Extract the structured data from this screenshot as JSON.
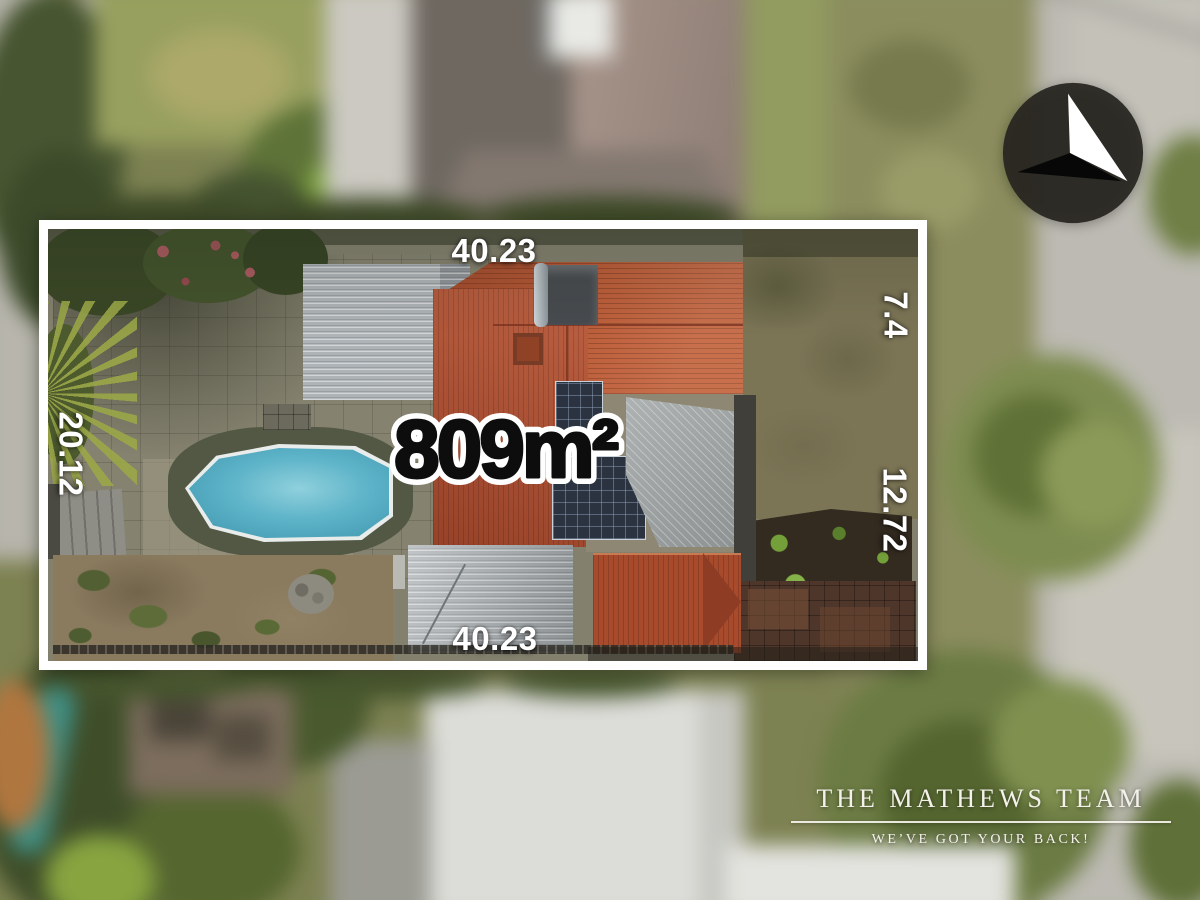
{
  "overlay": {
    "area_label": "809m²",
    "dimensions": {
      "top": "40.23",
      "bottom": "40.23",
      "left": "20.12",
      "right_upper": "7.4",
      "right_lower": "12.72"
    }
  },
  "branding": {
    "team_name": "THE MATHEWS TEAM",
    "tagline": "WE’VE GOT YOUR BACK!"
  },
  "icons": {
    "compass": "north-arrow-icon"
  },
  "colors": {
    "boundary": "#ffffff",
    "dimension_text": "#ffffff",
    "area_text": "#0d0d0d",
    "area_outline": "#ffffff",
    "roof_terracotta": "#b65a38",
    "pool_water": "#5fb3c8",
    "compass_disc": "#27251f",
    "brand_text": "#f3f1ea"
  }
}
